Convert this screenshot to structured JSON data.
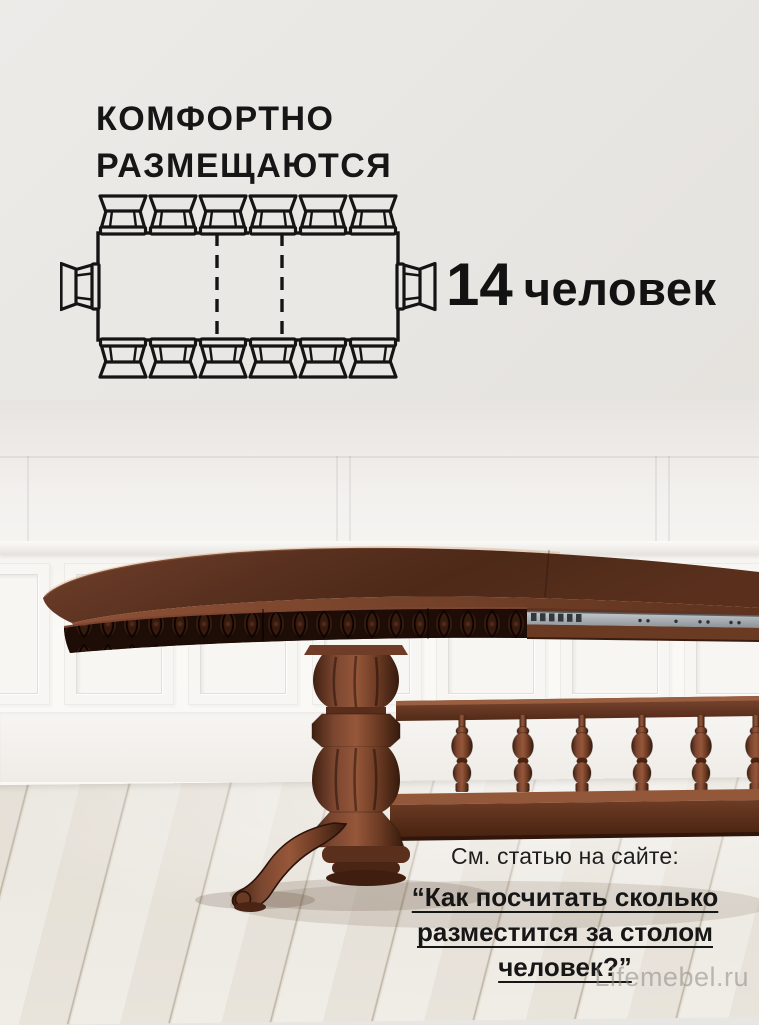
{
  "title": {
    "line1": "КОМФОРТНО",
    "line2": "РАЗМЕЩАЮТСЯ"
  },
  "capacity": {
    "number": "14",
    "unit": "человек"
  },
  "diagram": {
    "type": "seating-plan-top-view",
    "table_shape": "rectangular extendable table with dashed extension-leaf markers",
    "leaf_marker_count": 2,
    "chairs_top": 6,
    "chairs_bottom": 6,
    "chairs_left": 1,
    "chairs_right": 1,
    "total_seats": 14
  },
  "footer": {
    "lead": "См. статью на сайте:",
    "article_title_lines": [
      "“Как посчитать сколько",
      "разместится за столом",
      "человек?”"
    ]
  },
  "watermark": "Lifemebel.ru",
  "colors": {
    "background": "#e8e6e2",
    "text": "#161616",
    "diagram_stroke": "#141414",
    "wood": "#5f3422",
    "wood_dark": "#2c140b",
    "carving": "#1e0c06",
    "metal_rail": "#aeb4b8",
    "wall": "#f8f7f4",
    "floor": "#efece6",
    "watermark": "#8d8a84"
  }
}
